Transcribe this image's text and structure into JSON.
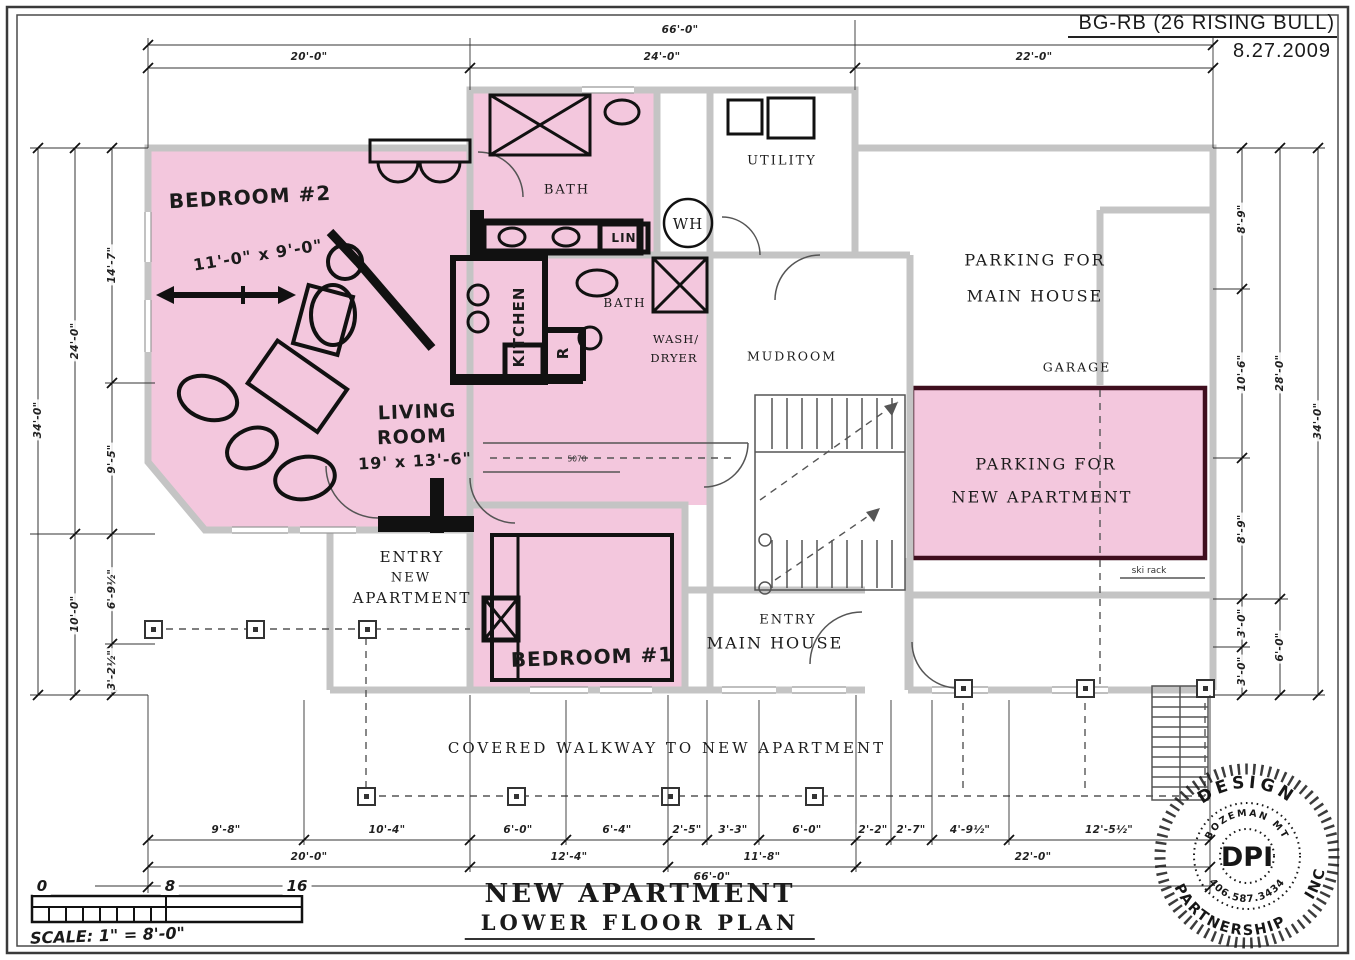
{
  "header": {
    "project": "BG-RB (26 RISING BULL)",
    "date": "8.27.2009"
  },
  "plan_title": {
    "line1": "NEW APARTMENT",
    "line2": "LOWER FLOOR PLAN"
  },
  "scale_bar": {
    "label": "SCALE: 1\" = 8'-0\"",
    "tick0": "0",
    "tick1": "8",
    "tick2": "16"
  },
  "stamp": {
    "center": "DPI",
    "outer_top": "DESIGN",
    "outer_bottom": "PARTNERSHIP",
    "outer_right": "INC",
    "inner_top": "BOZEMAN MT",
    "inner_bottom": "406.587.3434"
  },
  "rooms": {
    "bedroom2": "BEDROOM #2",
    "bedroom2_dims": "11'-0\" x 9'-0\"",
    "living1": "LIVING",
    "living2": "ROOM",
    "living3": "19' x 13'-6\"",
    "kitchen": "KITCHEN",
    "bath_upper": "BATH",
    "lin": "LIN",
    "utility": "UTILITY",
    "wh": "WH",
    "bath_lower": "BATH",
    "wash1": "WASH/",
    "wash2": "DRYER",
    "mudroom": "MUDROOM",
    "fridge": "R",
    "window_tag": "5070",
    "parking_main1": "PARKING FOR",
    "parking_main2": "MAIN HOUSE",
    "garage": "GARAGE",
    "parking_new1": "PARKING FOR",
    "parking_new2": "NEW APARTMENT",
    "ski_rack": "ski rack",
    "entry_new1": "ENTRY",
    "entry_new2": "NEW",
    "entry_new3": "APARTMENT",
    "bedroom1": "BEDROOM #1",
    "entry_main1": "ENTRY",
    "entry_main2": "MAIN HOUSE",
    "walkway": "COVERED WALKWAY TO NEW APARTMENT"
  },
  "dimensions": {
    "top_total": "66'-0\"",
    "top": [
      "20'-0\"",
      "24'-0\"",
      "22'-0\""
    ],
    "left_outer": "34'-0\"",
    "left_mid": [
      "24'-0\"",
      "10'-0\""
    ],
    "left_inner": [
      "14'-7\"",
      "9'-5\"",
      "6'-9½\"",
      "3'-2½\""
    ],
    "right_outer": "34'-0\"",
    "right_mid": [
      "28'-0\"",
      "6'-0\""
    ],
    "right_inner": [
      "8'-9\"",
      "10'-6\"",
      "8'-9\"",
      "3'-0\"",
      "3'-0\""
    ],
    "bottom_row1": [
      "9'-8\"",
      "10'-4\"",
      "6'-0\"",
      "6'-4\"",
      "2'-5\"",
      "3'-3\"",
      "6'-0\"",
      "2'-2\"",
      "2'-7\"",
      "4'-9½\"",
      "12'-5½\""
    ],
    "bottom_row2": [
      "20'-0\"",
      "12'-4\"",
      "11'-8\"",
      "22'-0\""
    ],
    "bottom_total": "66'-0\""
  },
  "colors": {
    "highlight_pink": "#F3C7DD",
    "wall_gray": "#C4C4C4",
    "parking_border": "#3F0E1E",
    "ink": "#1A1A1A"
  }
}
